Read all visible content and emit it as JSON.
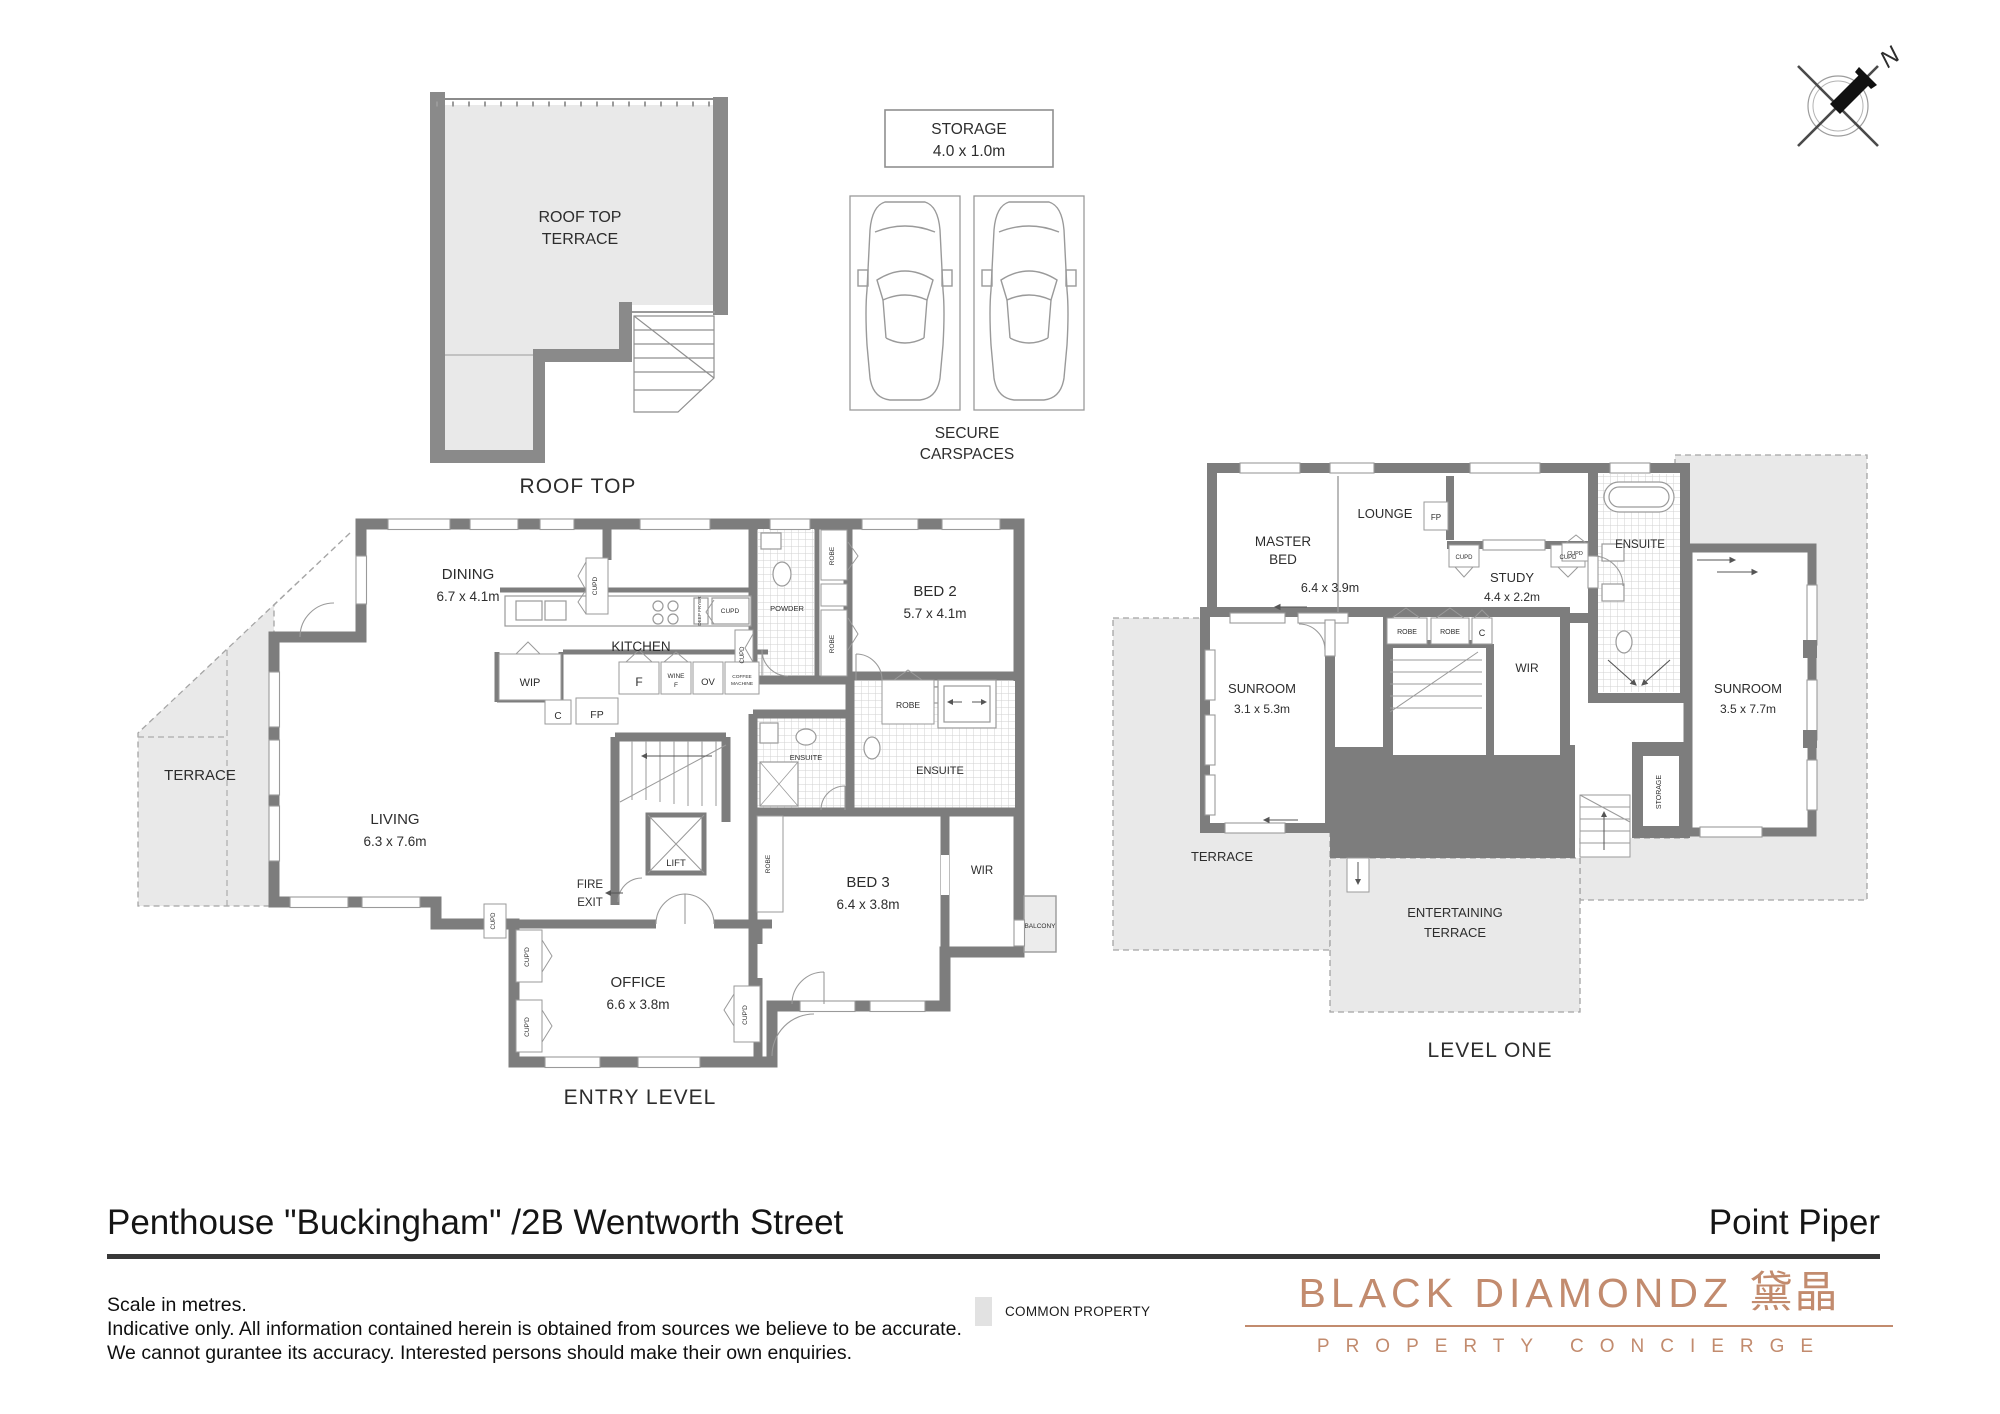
{
  "header": {
    "title": "Penthouse \"Buckingham\" /2B Wentworth Street",
    "suburb": "Point Piper"
  },
  "notes": {
    "line1": "Scale in metres.",
    "line2": "Indicative only. All information contained herein is obtained from sources we believe to be accurate.",
    "line3": "We cannot gurantee its accuracy. Interested persons should make their own enquiries."
  },
  "legend": {
    "common_property": "COMMON PROPERTY",
    "swatch_color": "#e8e8e8"
  },
  "brand": {
    "name": "BLACK DIAMONDZ",
    "cjk": "黛晶",
    "tagline": "PROPERTY CONCIERGE",
    "color": "#c28b6e"
  },
  "compass": {
    "north": "N"
  },
  "roof_plan": {
    "room_line1": "ROOF TOP",
    "room_line2": "TERRACE",
    "caption": "ROOF TOP"
  },
  "garage": {
    "storage_line1": "STORAGE",
    "storage_line2": "4.0 x 1.0m",
    "caption_line1": "SECURE",
    "caption_line2": "CARSPACES"
  },
  "entry_level": {
    "caption": "ENTRY LEVEL",
    "terrace": "TERRACE",
    "dining_name": "DINING",
    "dining_dims": "6.7 x 4.1m",
    "kitchen": "KITCHEN",
    "living_name": "LIVING",
    "living_dims": "6.3 x 7.6m",
    "powder": "POWDER",
    "bed2_name": "BED 2",
    "bed2_dims": "5.7 x 4.1m",
    "bed3_name": "BED 3",
    "bed3_dims": "6.4 x 3.8m",
    "office_name": "OFFICE",
    "office_dims": "6.6 x 3.8m",
    "ensuite_bed2": "ENSUITE",
    "ensuite_bed3": "ENSUITE",
    "wir": "WIR",
    "balcony": "BALCONY",
    "fire_exit_line1": "FIRE",
    "fire_exit_line2": "EXIT",
    "lift": "LIFT",
    "wip": "WIP",
    "fp": "FP",
    "c": "C",
    "fridge": "F",
    "wine_line1": "WINE",
    "wine_line2": "F",
    "oven": "OV",
    "coffee_line1": "COFFEE",
    "coffee_line2": "MACHINE",
    "deep_fryer": "DEEP FRYER",
    "robe": "ROBE",
    "cupd": "CUPD",
    "cupd_ap": "CUP'D"
  },
  "level_one": {
    "caption": "LEVEL ONE",
    "master_line1": "MASTER",
    "master_line2": "BED",
    "master_dims": "6.4 x 3.9m",
    "lounge": "LOUNGE",
    "study_name": "STUDY",
    "study_dims": "4.4 x 2.2m",
    "ensuite": "ENSUITE",
    "sunroom_small_name": "SUNROOM",
    "sunroom_small_dims": "3.1 x 5.3m",
    "sunroom_large_name": "SUNROOM",
    "sunroom_large_dims": "3.5 x 7.7m",
    "terrace": "TERRACE",
    "entertaining_line1": "ENTERTAINING",
    "entertaining_line2": "TERRACE",
    "wir": "WIR",
    "storage": "STORAGE",
    "fp": "FP",
    "robe": "ROBE",
    "c": "C",
    "cupd": "CUPD"
  }
}
